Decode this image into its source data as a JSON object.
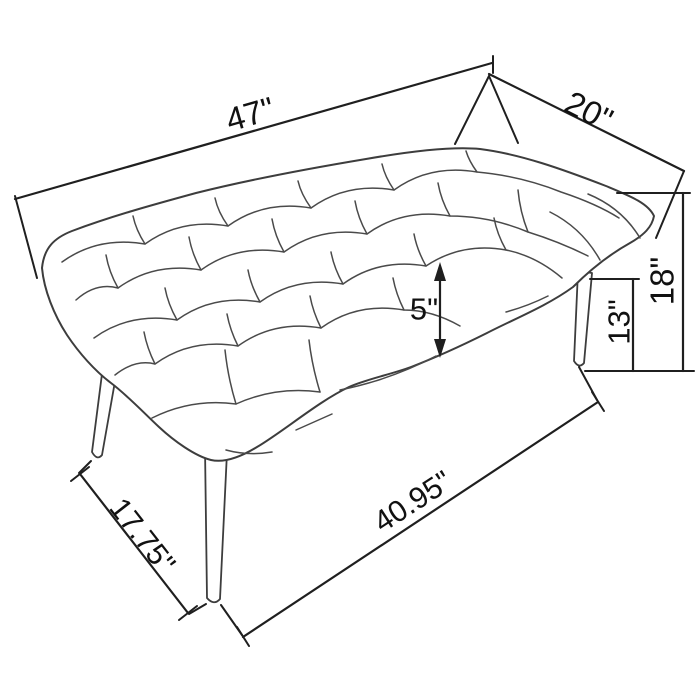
{
  "diagram": {
    "subject": "Tufted upholstered bench dimension drawing",
    "units": "inches",
    "colors": {
      "background": "#ffffff",
      "dimension_line": "#1f1f1f",
      "sketch_line": "#4a4a4a",
      "text": "#111111"
    },
    "labels": {
      "overall_length": "47\"",
      "overall_depth": "20\"",
      "cushion_thickness": "5\"",
      "leg_height": "13\"",
      "overall_height": "18\"",
      "footprint_depth": "17.75\"",
      "footprint_length": "40.95\""
    }
  }
}
